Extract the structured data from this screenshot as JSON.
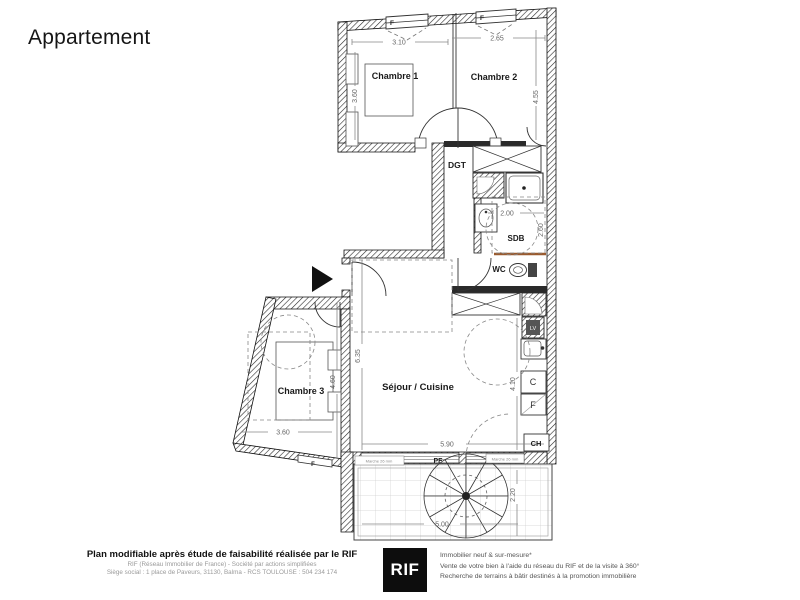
{
  "title": "Appartement",
  "plan": {
    "rooms": {
      "chambre1": "Chambre 1",
      "chambre2": "Chambre 2",
      "chambre3": "Chambre 3",
      "dgt": "DGT",
      "sdb": "SDB",
      "wc": "WC",
      "sejour": "Séjour / Cuisine"
    },
    "fixtures": {
      "lv": "LV",
      "c": "C",
      "f": "F",
      "ch": "CH"
    },
    "openings": {
      "window": "F",
      "french_window": "PF"
    },
    "notes": {
      "threshold": "Marche 26 mm"
    },
    "dims": {
      "d310": "3.10",
      "d265": "2.65",
      "d360_ch1": "3.60",
      "d455": "4.55",
      "d200": "2.00",
      "d260": "2.60",
      "d635": "6.35",
      "d460": "4.60",
      "d360_ch3": "3.60",
      "d410": "4.10",
      "d590": "5.90",
      "d500": "5.00",
      "d220": "2.20"
    }
  },
  "footer": {
    "left": {
      "bold": "Plan modifiable après étude de faisabilité réalisée par le RIF",
      "line1": "RIF (Réseau Immobilier de France) - Société par actions simplifiées",
      "line2": "Siège social : 1 place de Paveurs, 31130, Balma - RCS TOULOUSE : 504 234 174"
    },
    "logo": "RIF",
    "right": {
      "line1": "Immobilier neuf & sur-mesure*",
      "line2": "Vente de votre bien à l'aide du réseau du RIF et de la visite à 360°",
      "line3": "Recherche de terrains à bâtir destinés à la promotion immobilière"
    }
  },
  "colors": {
    "wall": "#1a1a1a",
    "dimension": "#666666",
    "accent_line": "#9a5b2f"
  }
}
